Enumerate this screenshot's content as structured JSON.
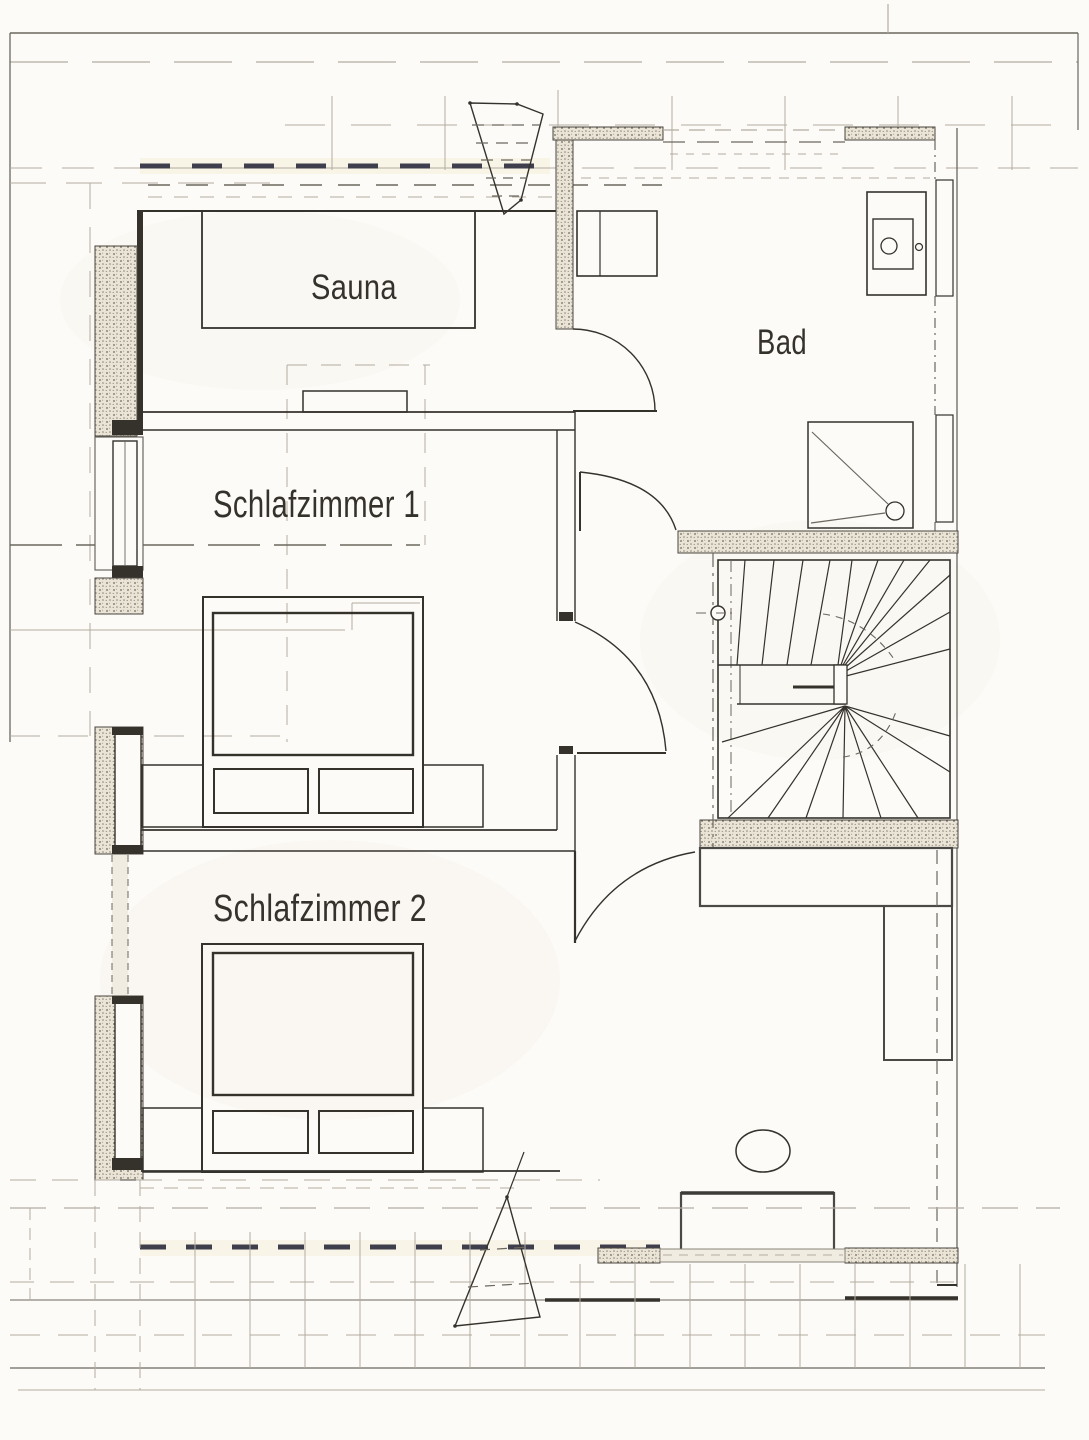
{
  "rooms": [
    {
      "id": "sauna",
      "label": "Sauna"
    },
    {
      "id": "bad",
      "label": "Bad"
    },
    {
      "id": "schlafzimmer1",
      "label": "Schlafzimmer 1"
    },
    {
      "id": "schlafzimmer2",
      "label": "Schlafzimmer 2"
    }
  ],
  "fixtures": [
    "sauna-cabin",
    "sauna-bench",
    "washing-machine",
    "washbasin",
    "shower",
    "winder-staircase",
    "double-bed",
    "mattress",
    "pillow",
    "nightstand",
    "wardrobe",
    "desk",
    "chair",
    "window",
    "door-swing",
    "roof-slope-line",
    "dormer",
    "chimney"
  ],
  "palette": {
    "paper": "#fcfbf7",
    "ink": "#35322c",
    "wall_line": "#6b675f",
    "wall_fill": "#eae4d6",
    "furniture": "#4b4945",
    "accent_dark": "#3e3e4c",
    "light_line": "#b3ada1",
    "tint": "#f4eed8"
  }
}
